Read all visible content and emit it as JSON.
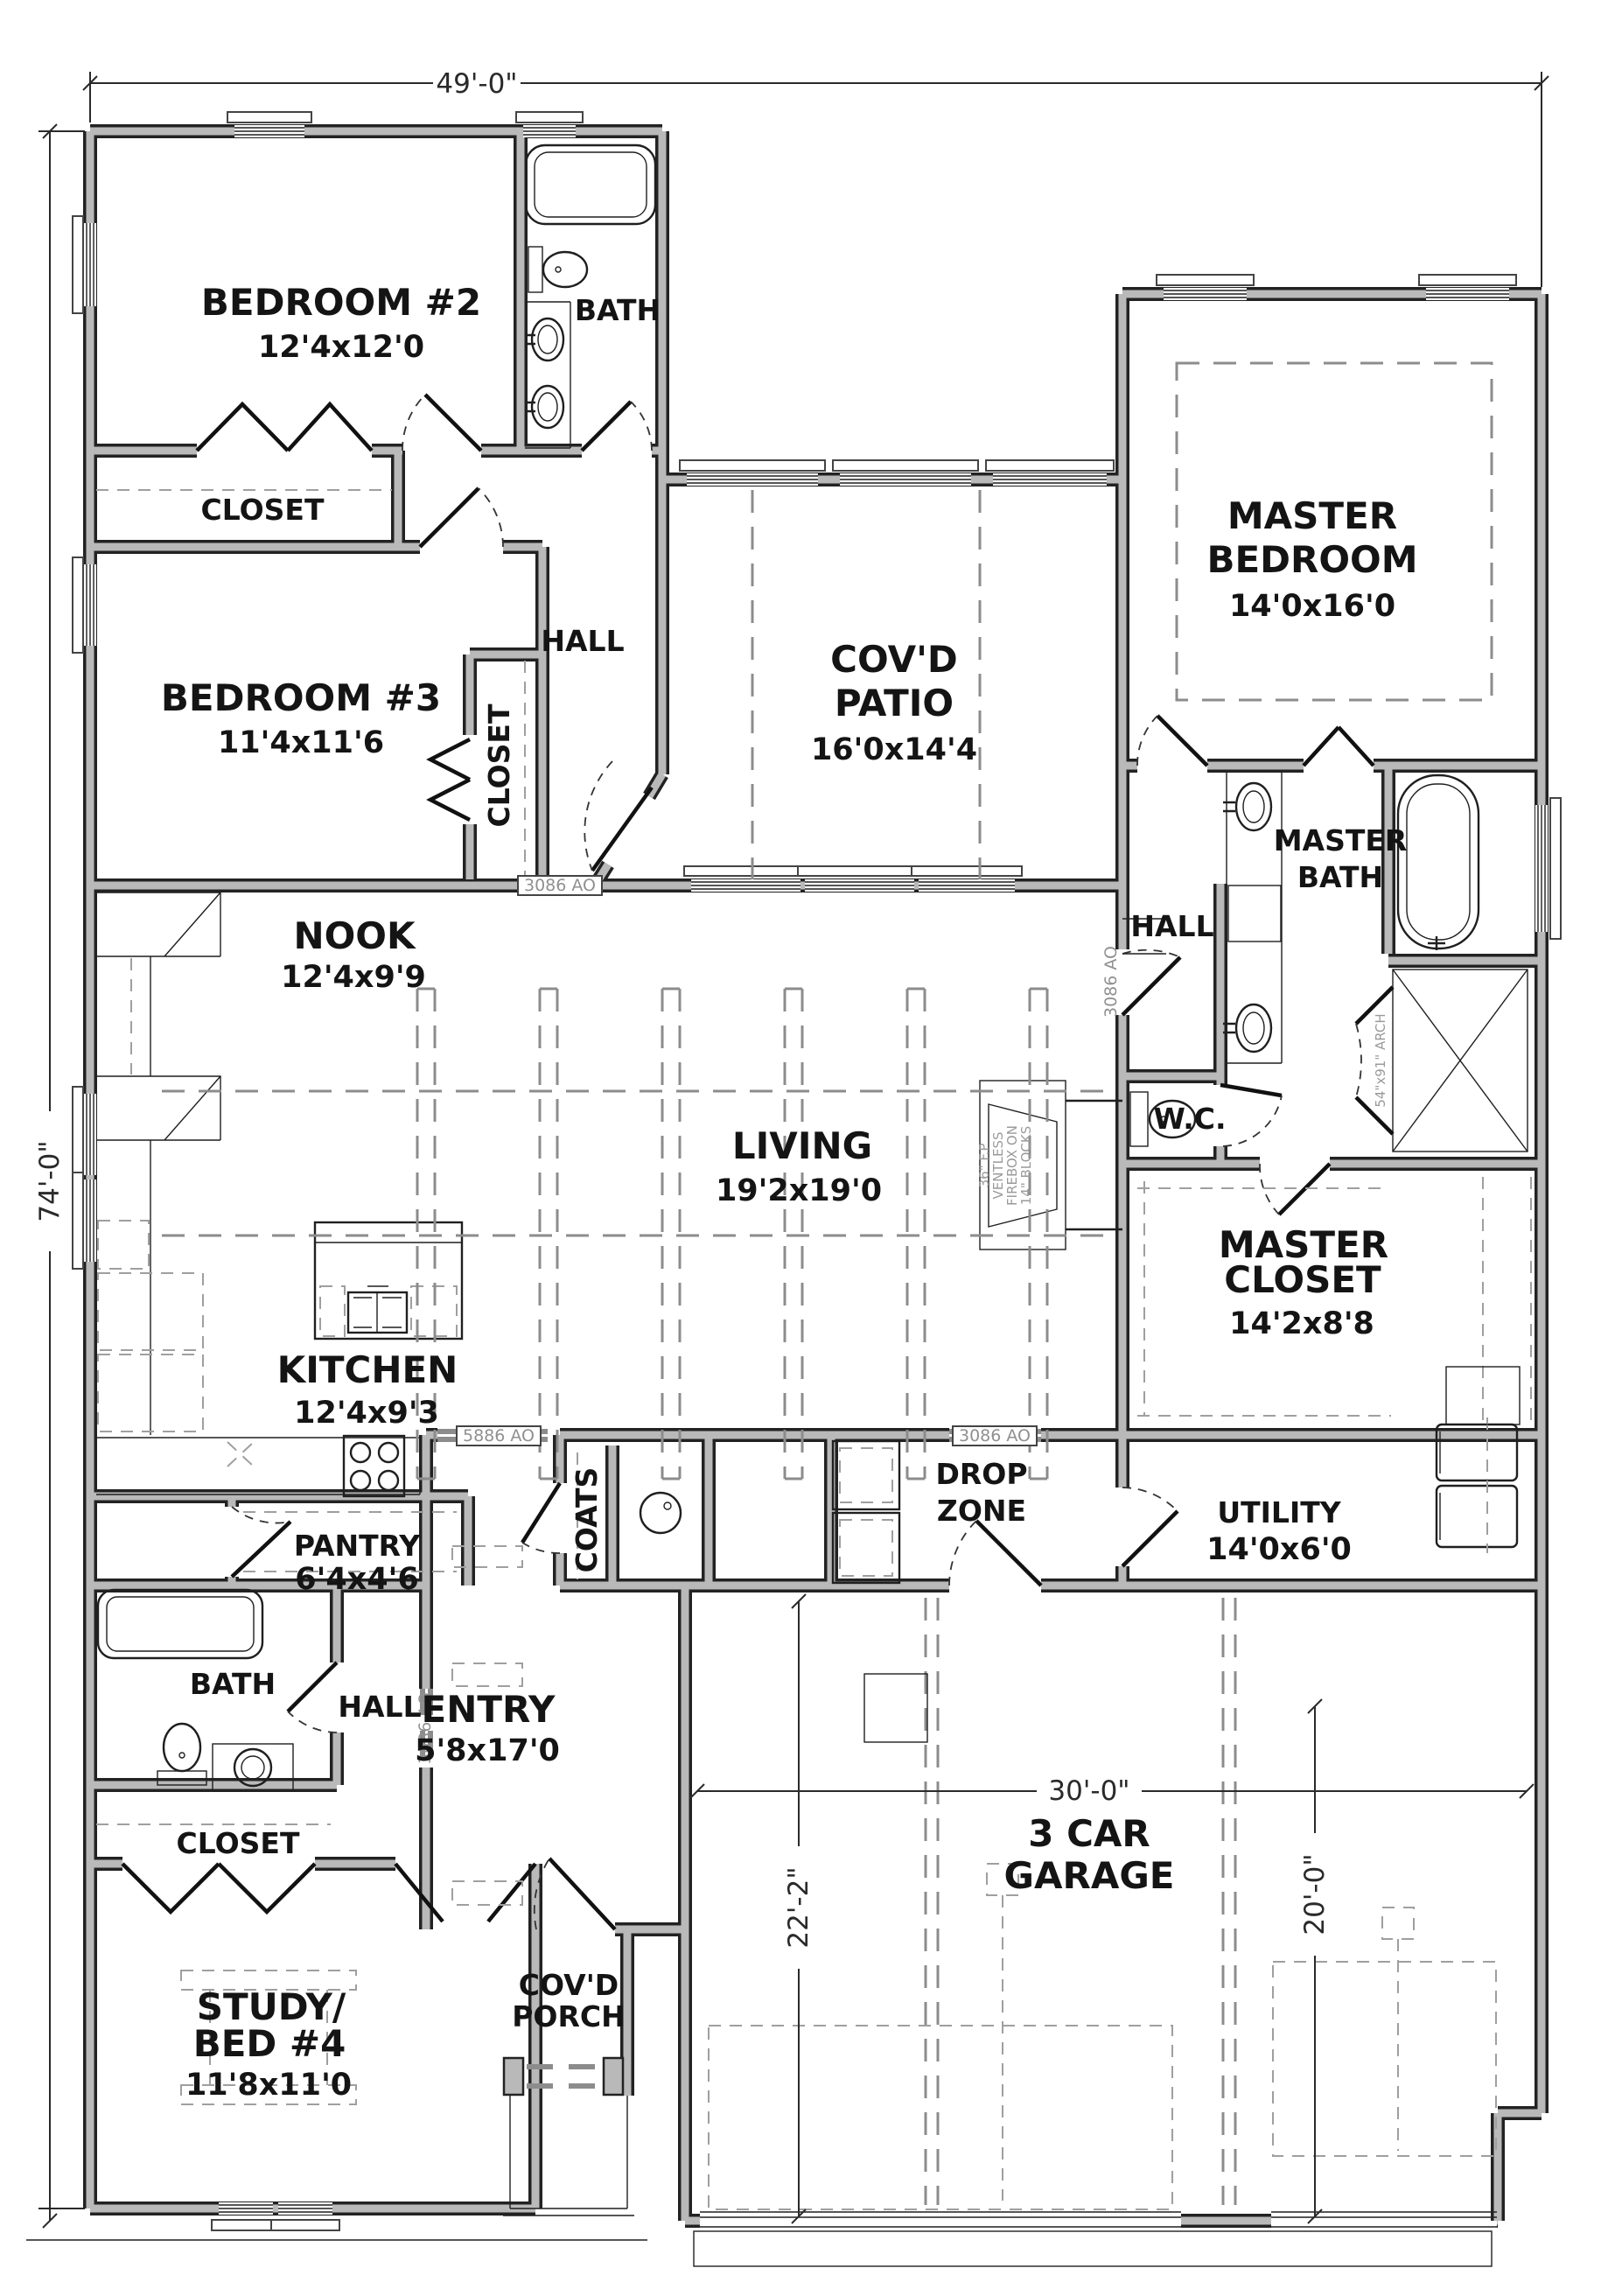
{
  "plan_title": "Floor Plan",
  "dimensions": {
    "overall_width": "49'-0\"",
    "overall_depth": "74'-0\"",
    "garage_width": "30'-0\"",
    "garage_left_depth": "22'-2\"",
    "garage_right_depth": "20'-0\""
  },
  "rooms": {
    "bedroom2": {
      "name": "BEDROOM #2",
      "size": "12'4x12'0"
    },
    "bath_top": {
      "name": "BATH"
    },
    "closet_bed2": {
      "name": "CLOSET"
    },
    "bedroom3": {
      "name": "BEDROOM #3",
      "size": "11'4x11'6"
    },
    "closet_bed3": {
      "name": "CLOSET"
    },
    "hall_top": {
      "name": "HALL"
    },
    "covd_patio": {
      "line1": "COV'D",
      "line2": "PATIO",
      "size": "16'0x14'4"
    },
    "master_bedroom": {
      "line1": "MASTER",
      "line2": "BEDROOM",
      "size": "14'0x16'0"
    },
    "master_bath": {
      "line1": "MASTER",
      "line2": "BATH"
    },
    "hall_master": {
      "name": "HALL"
    },
    "wc": {
      "name": "W.C."
    },
    "nook": {
      "name": "NOOK",
      "size": "12'4x9'9"
    },
    "living": {
      "name": "LIVING",
      "size": "19'2x19'0"
    },
    "kitchen": {
      "name": "KITCHEN",
      "size": "12'4x9'3"
    },
    "pantry": {
      "name": "PANTRY",
      "size": "6'4x4'6"
    },
    "coats": {
      "name": "COATS"
    },
    "drop_zone": {
      "line1": "DROP",
      "line2": "ZONE"
    },
    "utility": {
      "name": "UTILITY",
      "size": "14'0x6'0"
    },
    "master_closet": {
      "line1": "MASTER",
      "line2": "CLOSET",
      "size": "14'2x8'8"
    },
    "bath2": {
      "name": "BATH"
    },
    "hall2": {
      "name": "HALL"
    },
    "entry": {
      "name": "ENTRY",
      "size": "5'8x17'0"
    },
    "closet_study": {
      "name": "CLOSET"
    },
    "study": {
      "line1": "STUDY/",
      "line2": "BED #4",
      "size": "11'8x11'0"
    },
    "covd_porch": {
      "line1": "COV'D",
      "line2": "PORCH"
    },
    "garage": {
      "line1": "3 CAR",
      "line2": "GARAGE"
    }
  },
  "wall_tags": {
    "hall_patio": "3086 AO",
    "living_drop": "3086 AO",
    "living_hall_door": "3086 AO",
    "entry_hall": "3086 AO",
    "kitchen_entry": "5886 AO"
  },
  "notes": {
    "fireplace": [
      "36\" F.P",
      "VENTLESS",
      "FIREBOX ON",
      "14\" BLOCKS"
    ],
    "shower": "54\"x91\" ARCH"
  },
  "colors": {
    "wall_fill": "#b9b9b9",
    "line": "#222222",
    "ceiling_dash": "#8c8c8c",
    "tag_text": "#909090"
  }
}
